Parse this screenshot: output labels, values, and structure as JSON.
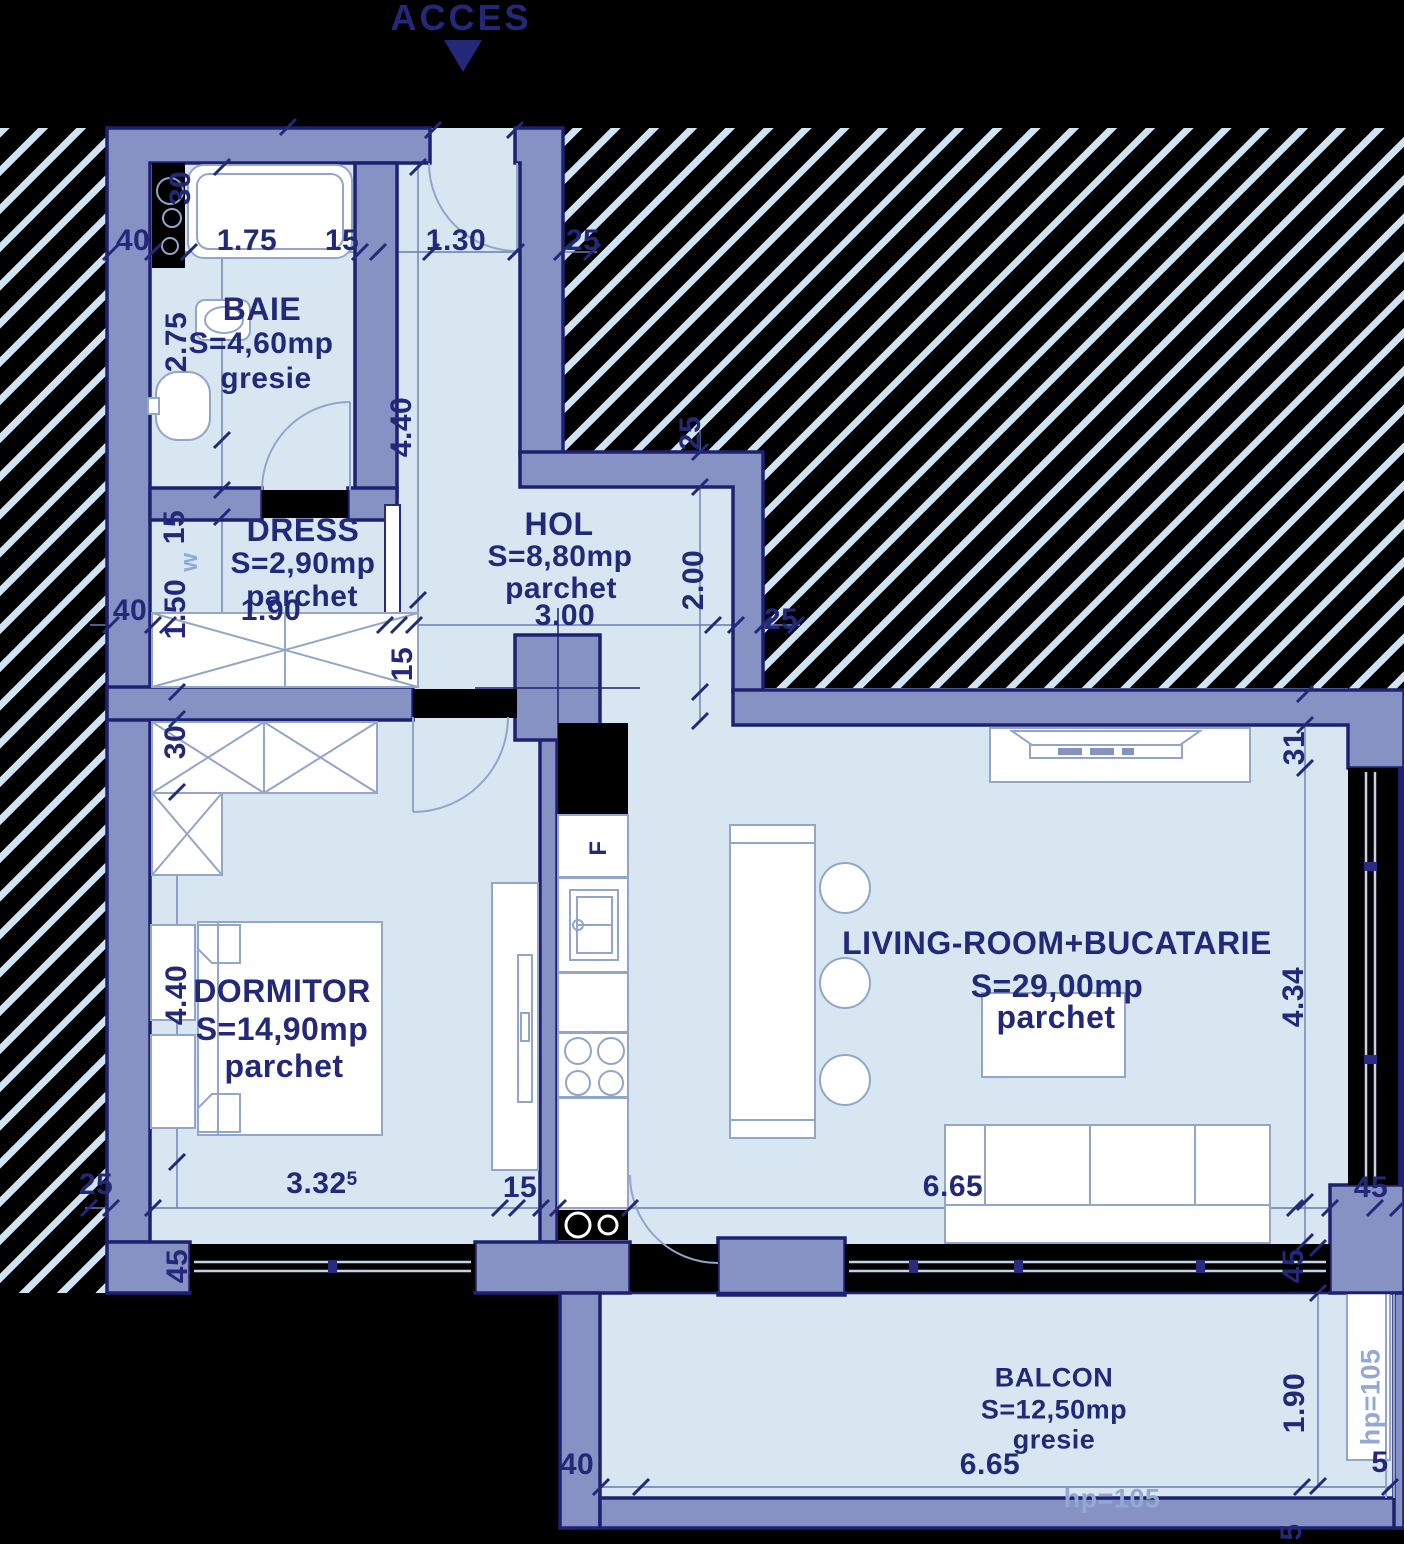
{
  "title": {
    "acces": "ACCES"
  },
  "colors": {
    "background": "#000000",
    "wall_fill": "#8792c4",
    "wall_outline": "#1e2170",
    "floor": "#d8e6f2",
    "hatch_line": "#cfe3f2",
    "label_navy": "#232878",
    "label_light": "#93a9d4",
    "furniture_stroke": "#93a5c9"
  },
  "rooms": {
    "baie": {
      "name": "BAIE",
      "area": "S=4,60mp",
      "floor": "gresie"
    },
    "dress": {
      "name": "DRESS",
      "area": "S=2,90mp",
      "floor": "parchet"
    },
    "hol": {
      "name": "HOL",
      "area": "S=8,80mp",
      "floor": "parchet"
    },
    "dormitor": {
      "name": "DORMITOR",
      "area": "S=14,90mp",
      "floor": "parchet"
    },
    "living": {
      "name": "LIVING-ROOM+BUCATARIE",
      "area": "S=29,00mp",
      "floor": "parchet"
    },
    "balcon": {
      "name": "BALCON",
      "area": "S=12,50mp",
      "floor": "gresie"
    }
  },
  "dims": {
    "left_wall_top": "40",
    "baie_width": "1.75",
    "baie_wall": "15",
    "entry_width": "1.30",
    "entry_wall": "25",
    "shaft_depth": "30",
    "baie_height": "2.75",
    "hol_height": "4.40",
    "dress_wall": "15",
    "washer": "w",
    "dress_height": "1.50",
    "left_wall_mid": "40",
    "dress_width": "1.90",
    "hol_width": "3.00",
    "hol_wall_top": "25",
    "hol_right_height": "2.00",
    "hol_wall_right": "25",
    "dorm_door": "15",
    "dorm_closet": "30",
    "dorm_height": "4.40",
    "dorm_width_main": "3.32",
    "dorm_width_sup": "5",
    "kitchen_wall": "15",
    "left_wall_bottom": "25",
    "dorm_window_wall": "45",
    "fridge": "F",
    "living_wall_top": "31",
    "living_height": "4.34",
    "living_width": "6.65",
    "living_wall_right": "45",
    "living_wall_bottom": "45",
    "balcony_wall": "40",
    "balcony_width": "6.65",
    "balcony_depth": "1.90",
    "balcony_parapet_side": "hp=105",
    "balcony_parapet_bottom": "hp=105",
    "balcony_edge_right": "5",
    "balcony_edge_bottom": "5"
  }
}
